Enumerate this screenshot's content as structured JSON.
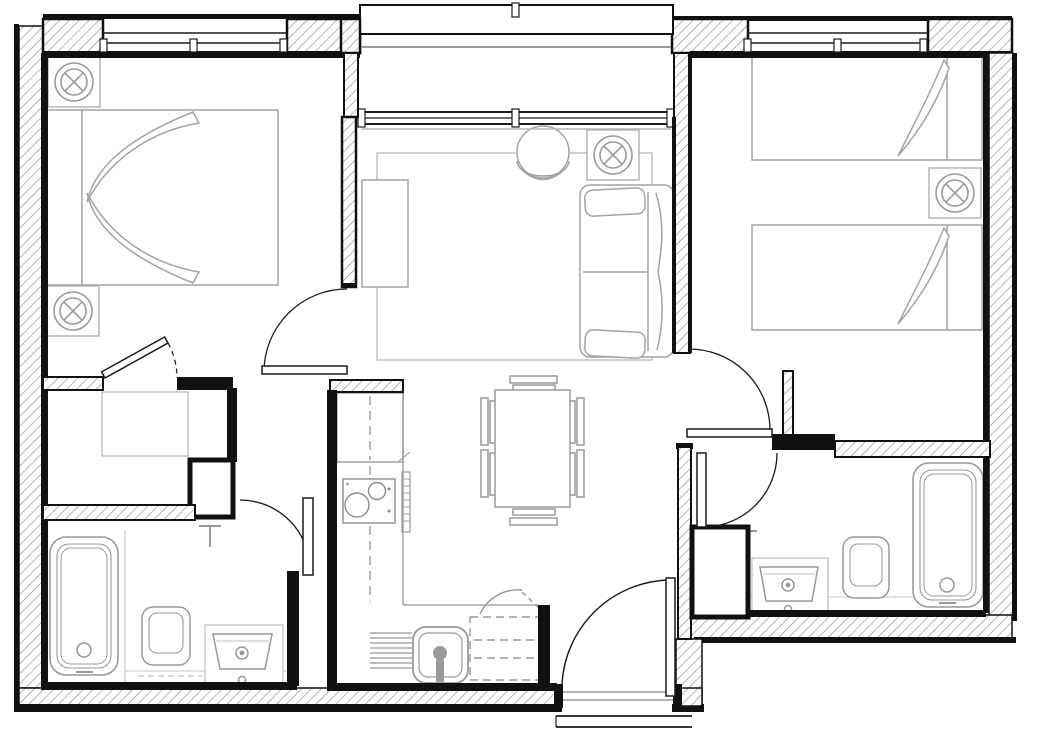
{
  "meta": {
    "document_type": "architectural-floor-plan",
    "description": "Black-and-white CAD floor plan of a two-bedroom, two-bathroom apartment with open living/dining/kitchen area, walk-in closet, entry hall and top balcony recess",
    "canvas": {
      "width": 1037,
      "height": 733
    }
  },
  "style": {
    "background": "#ffffff",
    "wall_outline": "#111111",
    "wall_hatch": "#8f8f8f",
    "furniture_line": "#a3a3a3",
    "fixture_line": "#999999",
    "light_rug_line": "#bbbbbb",
    "door_line": "#1a1a1a"
  },
  "rooms": [
    {
      "id": "bedroom-1",
      "label": "Bedroom 1 (double)",
      "position": "top-left",
      "contents": [
        "double-bed with folded quilt",
        "headboard",
        "2 ceiling-light symbols",
        "door from living room",
        "door to walk-in closet"
      ]
    },
    {
      "id": "walk-in-closet",
      "label": "Walk-in closet",
      "position": "mid-left",
      "contents": [
        "wardrobe outline",
        "service shaft"
      ]
    },
    {
      "id": "bathroom-1",
      "label": "Bathroom 1 (en-suite)",
      "position": "bottom-left",
      "contents": [
        "bathtub",
        "toilet",
        "vanity basin",
        "towel-radiator symbol",
        "inward swinging door"
      ]
    },
    {
      "id": "living-dining",
      "label": "Living / dining room",
      "position": "center",
      "contents": [
        "area rug",
        "tv-sideboard",
        "armchair",
        "2-seat sofa with cushions",
        "ceiling-light symbol",
        "dining table with 6 chairs"
      ]
    },
    {
      "id": "kitchen",
      "label": "Kitchen (L-shaped)",
      "position": "bottom-center-left",
      "contents": [
        "tall unit / fridge with dashed centerline",
        "2-burner hob",
        "counter edge",
        "drainer",
        "sink with tap",
        "dashed under-counter appliance",
        "cupboard swing arc"
      ]
    },
    {
      "id": "entry-hall",
      "label": "Entry hall",
      "position": "bottom-center",
      "contents": [
        "entrance door with swing arc",
        "threshold lines",
        "outside step lines"
      ]
    },
    {
      "id": "bedroom-2",
      "label": "Bedroom 2 (twin)",
      "position": "top-right",
      "contents": [
        "2 single beds with turned-down covers",
        "headboards",
        "ceiling-light symbol",
        "door with swing arc"
      ]
    },
    {
      "id": "bathroom-lobby",
      "label": "Bathroom lobby",
      "position": "mid-right",
      "contents": [
        "door with swing arc",
        "service shaft"
      ]
    },
    {
      "id": "bathroom-2",
      "label": "Bathroom 2",
      "position": "bottom-right",
      "contents": [
        "vanity basin",
        "toilet",
        "bathtub",
        "towel-radiator symbol"
      ]
    },
    {
      "id": "balcony-recess",
      "label": "Balcony recess",
      "position": "top-center",
      "contents": [
        "balcony edge lines",
        "full-width glazed wall"
      ]
    }
  ],
  "windows": [
    {
      "id": "window-bedroom-1",
      "wall": "top",
      "x": 103,
      "width": 184
    },
    {
      "id": "window-living",
      "wall": "top-recessed",
      "x": 358,
      "width": 317
    },
    {
      "id": "window-bedroom-2",
      "wall": "top",
      "x": 747,
      "width": 181
    }
  ],
  "doors": [
    {
      "id": "door-bedroom-1",
      "swing": "into bedroom 1"
    },
    {
      "id": "door-closet",
      "swing": "diagonal, dashed arc"
    },
    {
      "id": "door-bathroom-1",
      "swing": "into bathroom 1"
    },
    {
      "id": "door-entrance",
      "swing": "into entry hall"
    },
    {
      "id": "door-bedroom-2",
      "swing": "into bedroom 2"
    },
    {
      "id": "door-bathroom-lobby",
      "swing": "into lobby"
    }
  ],
  "symbols": {
    "ceiling_light_count": 4,
    "ceiling_light_glyph": "circle-with-X-in-square"
  }
}
